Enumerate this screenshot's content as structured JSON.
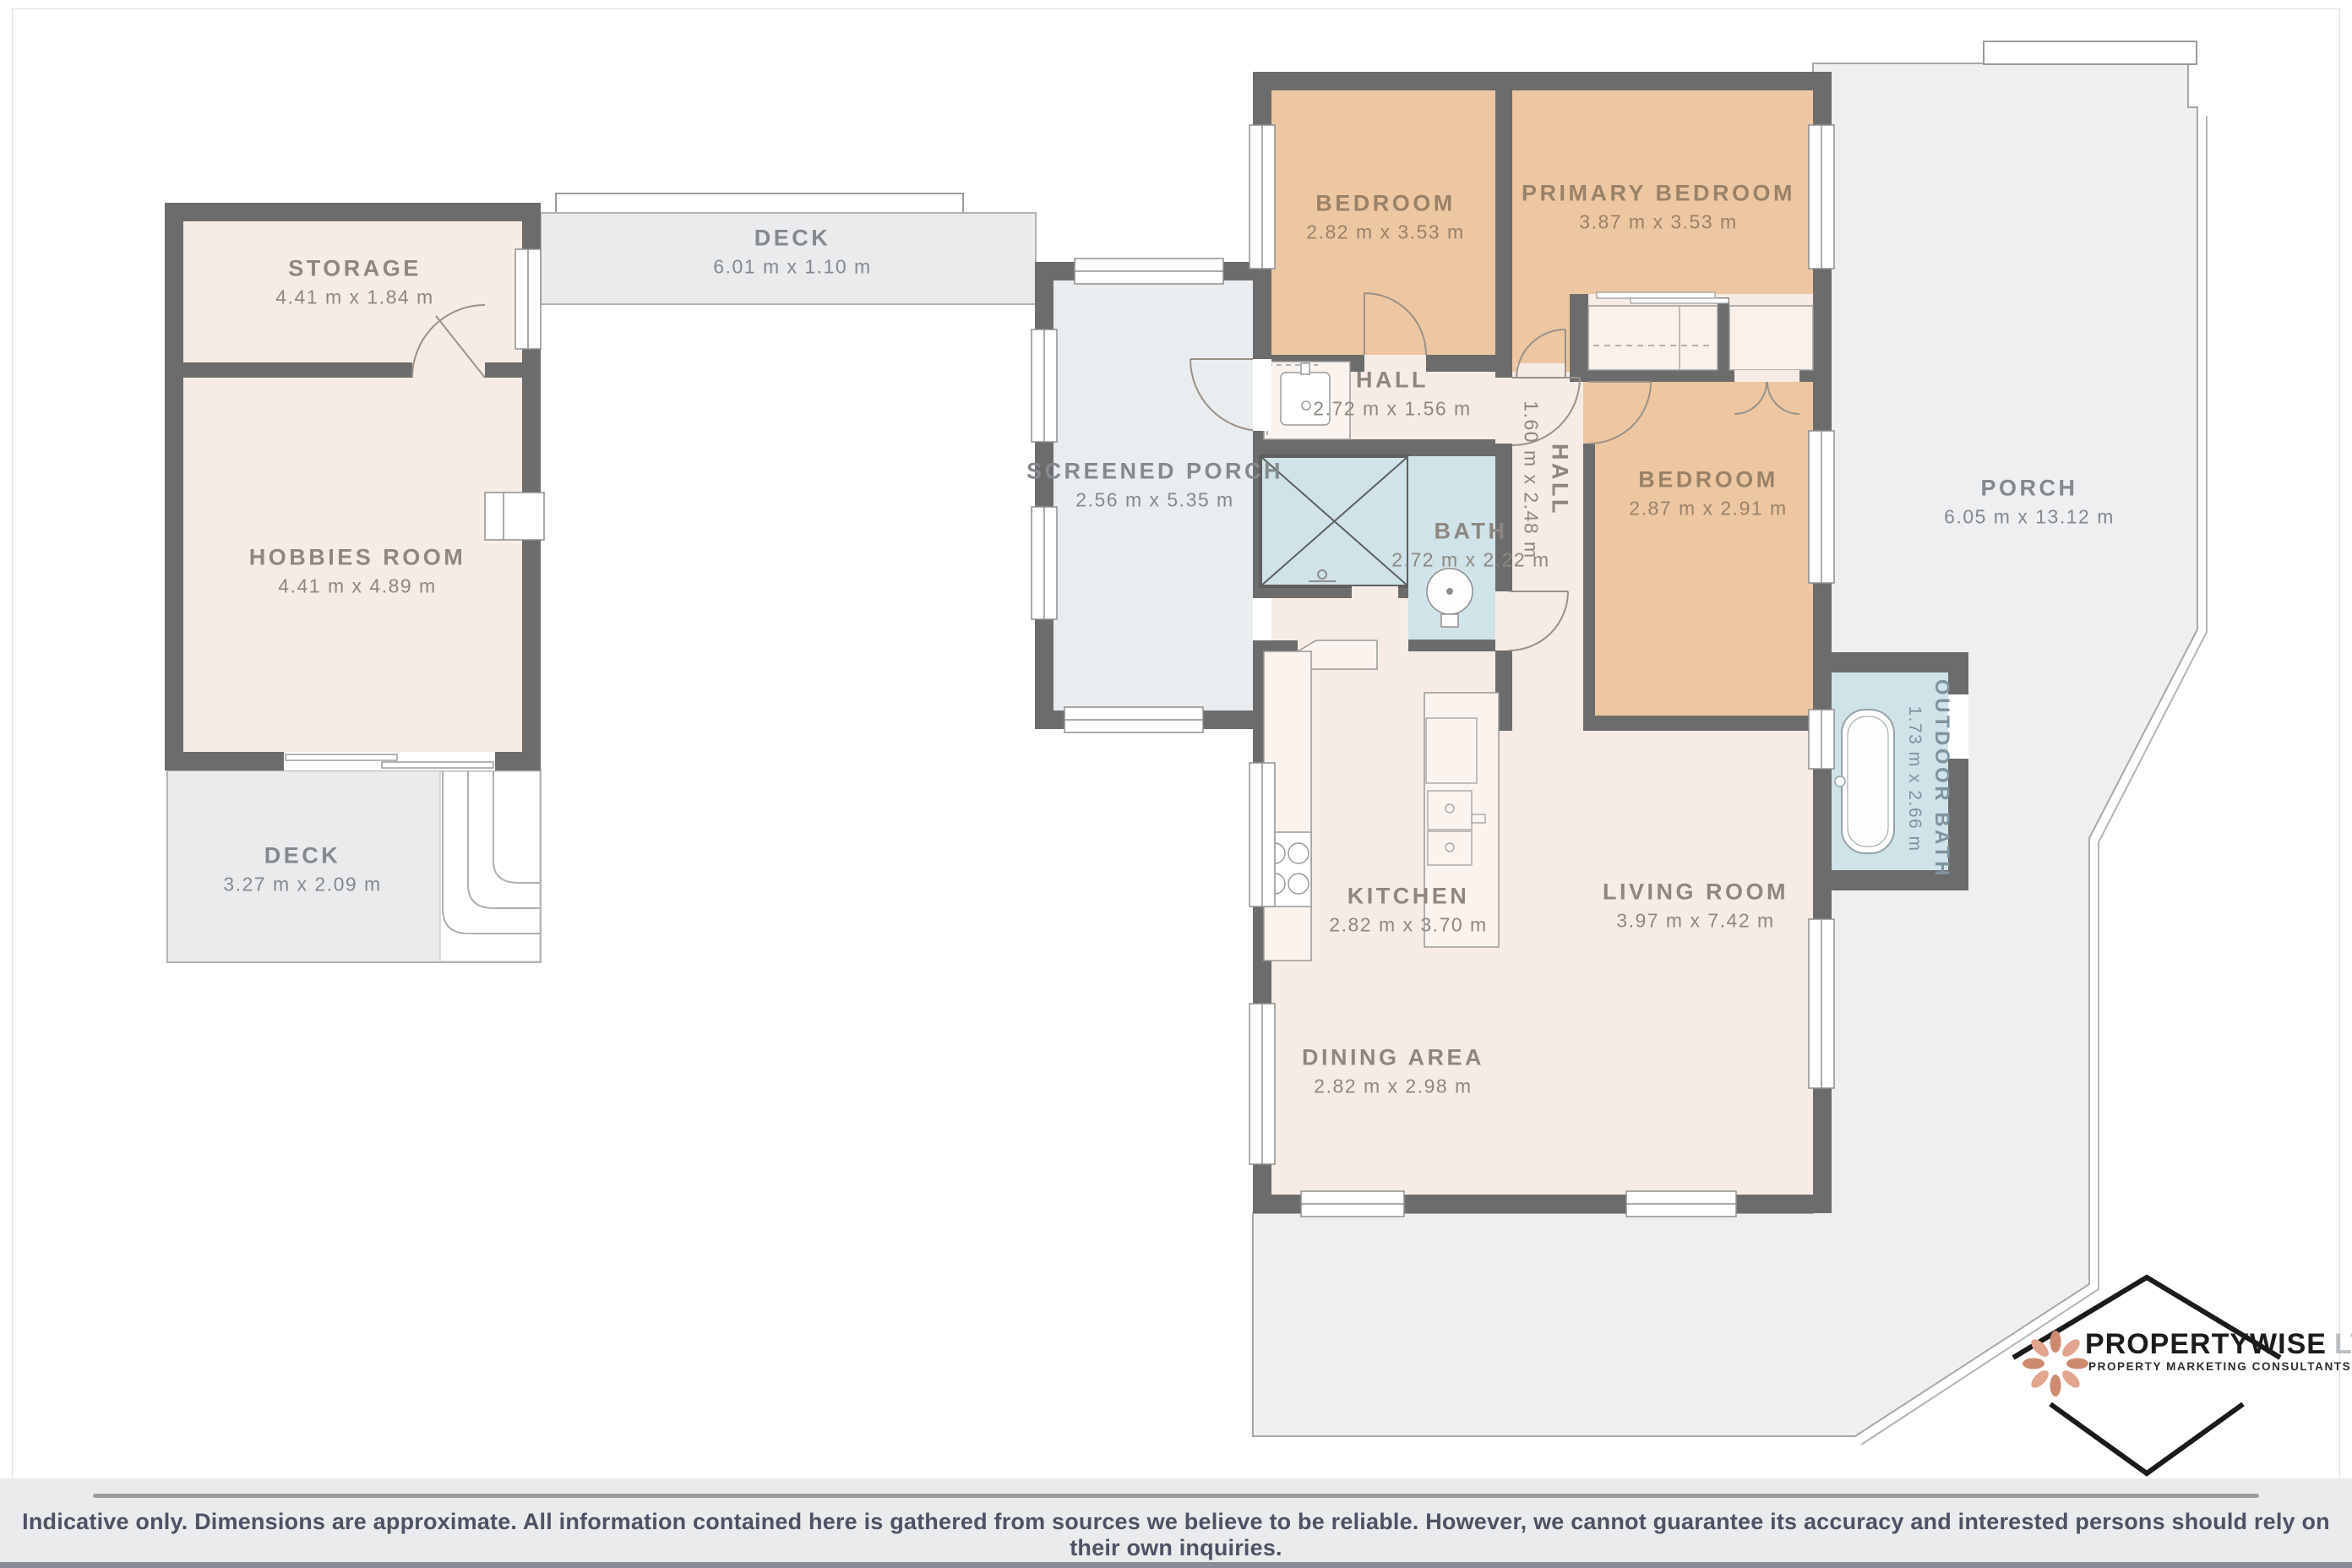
{
  "document": {
    "type": "residential floor plan"
  },
  "rooms": {
    "storage": {
      "label": "STORAGE",
      "dims": "4.41 m x 1.84 m"
    },
    "hobbies": {
      "label": "HOBBIES ROOM",
      "dims": "4.41 m x 4.89 m"
    },
    "deck_top": {
      "label": "DECK",
      "dims": "6.01 m x 1.10 m"
    },
    "deck_bottom": {
      "label": "DECK",
      "dims": "3.27 m x 2.09 m"
    },
    "screened_porch": {
      "label": "SCREENED PORCH",
      "dims": "2.56 m x 5.35 m"
    },
    "bedroom1": {
      "label": "BEDROOM",
      "dims": "2.82 m x 3.53 m"
    },
    "primary": {
      "label": "PRIMARY BEDROOM",
      "dims": "3.87 m x 3.53 m"
    },
    "hall1": {
      "label": "HALL",
      "dims": "2.72 m x 1.56 m"
    },
    "hall2": {
      "label": "HALL",
      "dims": "1.60 m x 2.48 m"
    },
    "bath": {
      "label": "BATH",
      "dims": "2.72 m x 2.22 m"
    },
    "bedroom2": {
      "label": "BEDROOM",
      "dims": "2.87 m x 2.91 m"
    },
    "porch": {
      "label": "PORCH",
      "dims": "6.05 m x 13.12 m"
    },
    "outdoor_bath": {
      "label": "OUTDOOR BATH",
      "dims": "1.73 m x 2.66 m"
    },
    "kitchen": {
      "label": "KITCHEN",
      "dims": "2.82 m x 3.70 m"
    },
    "living": {
      "label": "LIVING ROOM",
      "dims": "3.97 m x 7.42 m"
    },
    "dining": {
      "label": "DINING AREA",
      "dims": "2.82 m x 2.98 m"
    }
  },
  "branding": {
    "name": "PROPERTYWISE",
    "suffix": "LTD",
    "tagline": "PROPERTY MARKETING CONSULTANTS"
  },
  "footer": {
    "disclaimer": "Indicative only. Dimensions are approximate. All information contained here is gathered from sources we believe to be reliable. However, we cannot guarantee its accuracy and interested persons should rely on their own inquiries."
  },
  "colors": {
    "wall": "#6c6c6c",
    "room_fill": "#f7ece5",
    "bedroom_fill": "#edc7a2",
    "deck_fill": "#e9ebed",
    "porch_fill": "#edeff1",
    "water_fill": "#cfe3e8",
    "logo_petal": "#d8917b",
    "footer_text": "#4d5364"
  }
}
